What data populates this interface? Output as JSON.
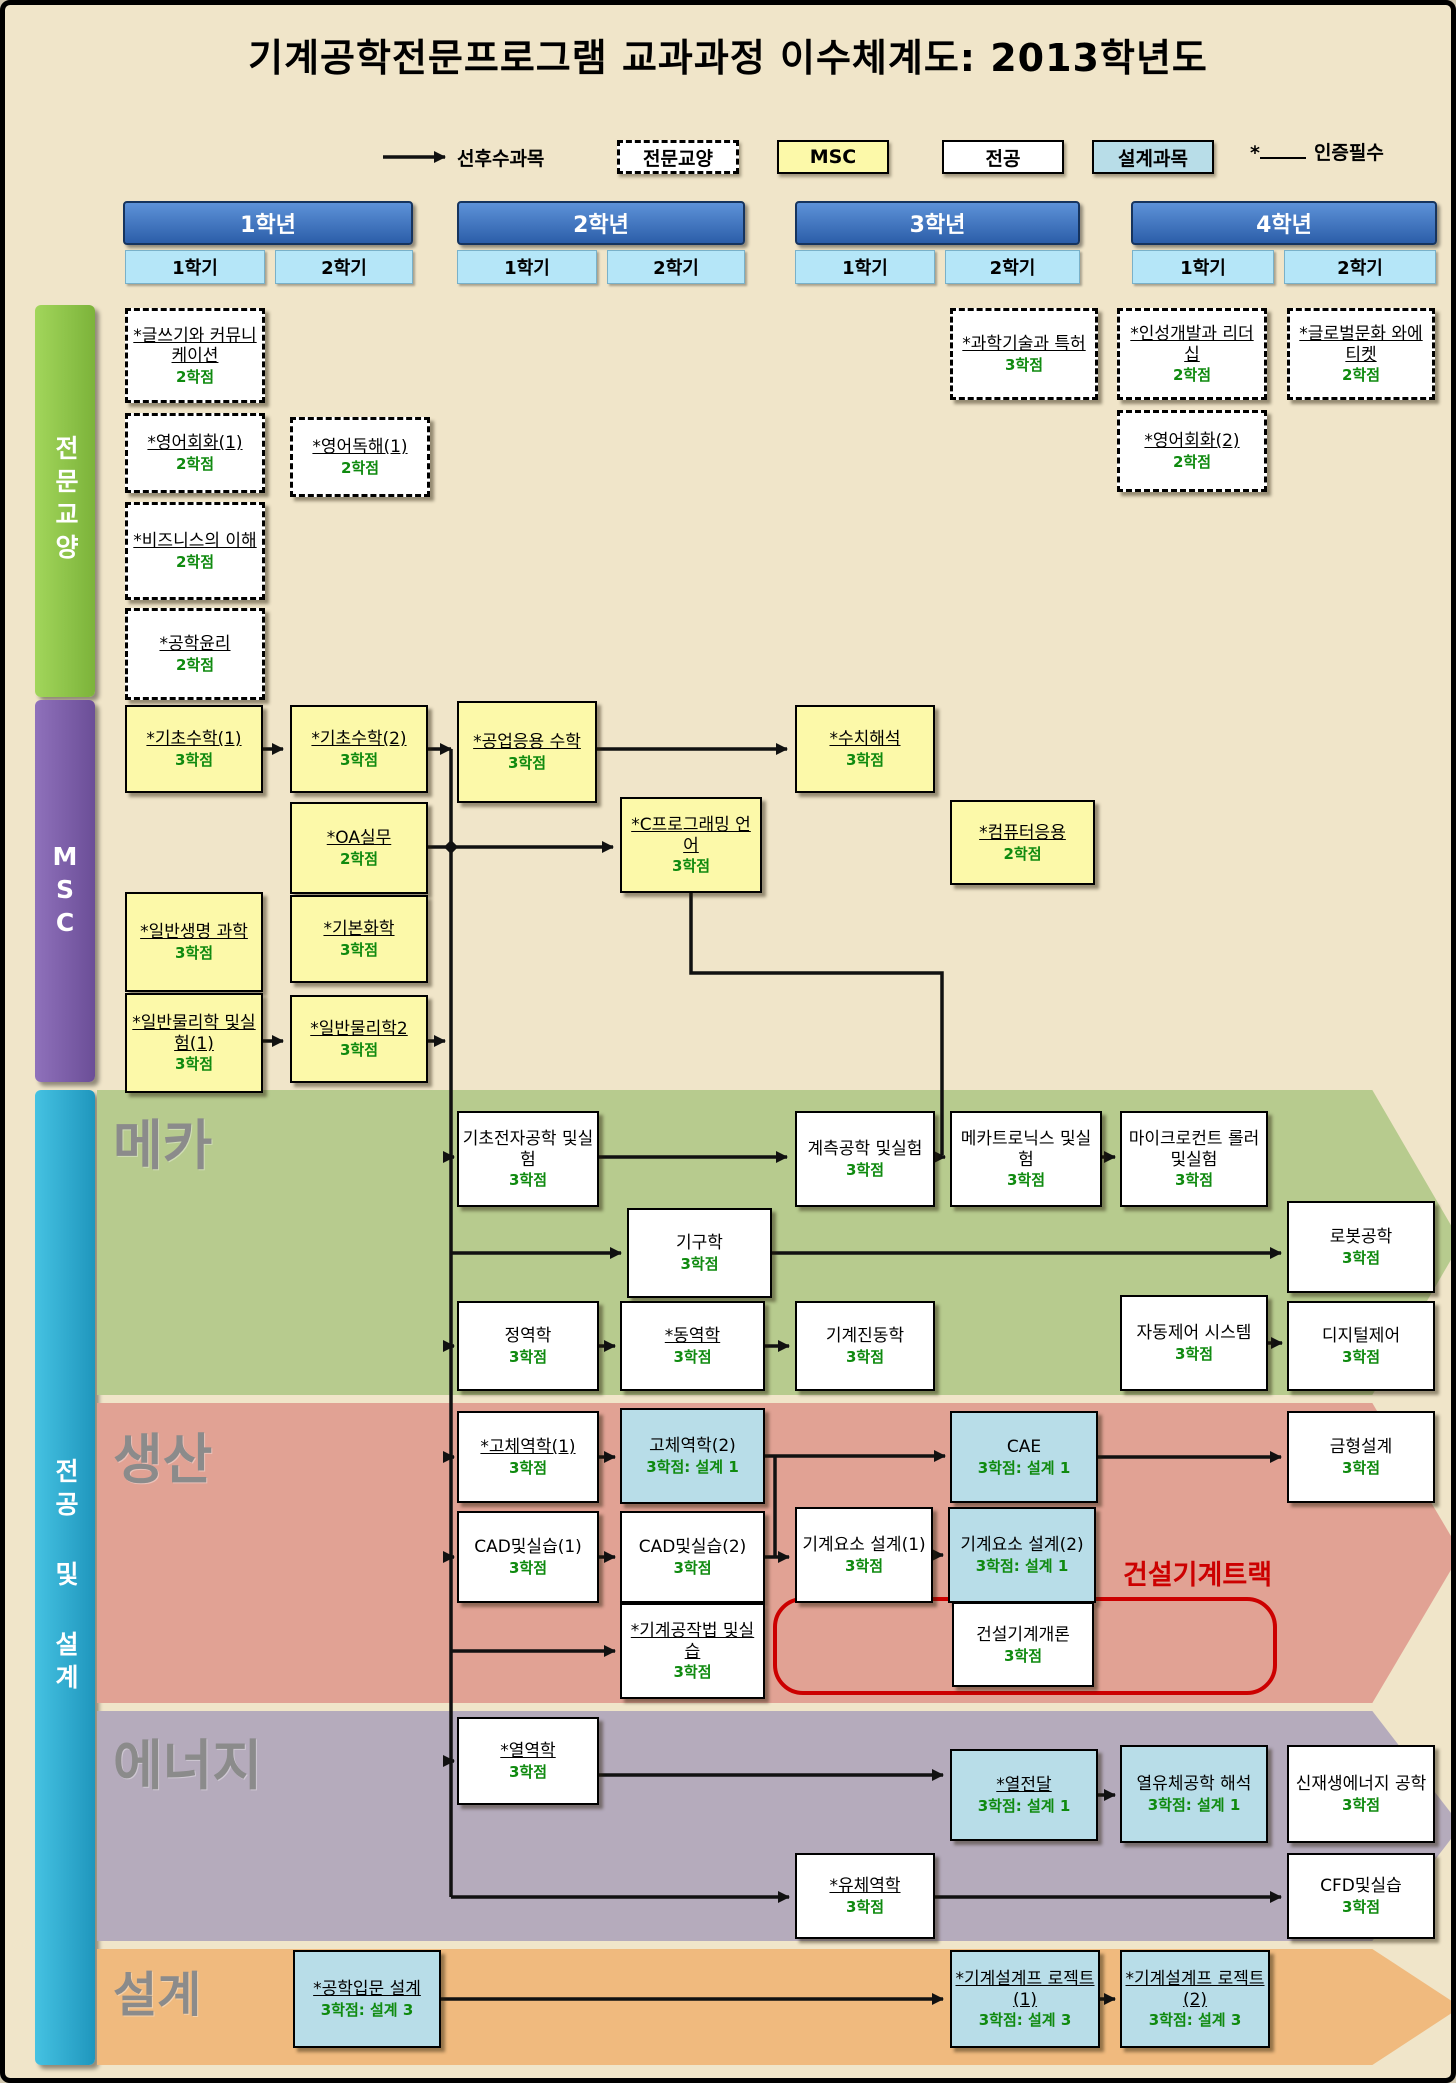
{
  "title": "기계공학전문프로그램 교과과정 이수체계도: 2013학년도",
  "legend": {
    "prereq_label": "선후수과목",
    "liberal_label": "전문교양",
    "msc_label": "MSC",
    "major_label": "전공",
    "design_label": "설계과목",
    "cert_label": "인증필수"
  },
  "years": [
    {
      "label": "1학년",
      "semesters": [
        "1학기",
        "2학기"
      ]
    },
    {
      "label": "2학년",
      "semesters": [
        "1학기",
        "2학기"
      ]
    },
    {
      "label": "3학년",
      "semesters": [
        "1학기",
        "2학기"
      ]
    },
    {
      "label": "4학년",
      "semesters": [
        "1학기",
        "2학기"
      ]
    }
  ],
  "sidebars": {
    "liberal": "전문교양",
    "msc": "MSC",
    "major": "전공 및 설계"
  },
  "bands": {
    "meka": "메카",
    "saengsan": "생산",
    "energy": "에너지",
    "seolgye": "설계"
  },
  "track": {
    "label": "건설기계트랙"
  },
  "colors": {
    "background": "#f0e5c9",
    "semester": "#b5e6f8",
    "liberal_sidebar": "#7cb33a",
    "msc_sidebar": "#6b4e97",
    "major_sidebar": "#1f96bd",
    "msc_box": "#fcf9a9",
    "design_box": "#b8dde8",
    "major_box": "#ffffff",
    "band_meka": "#b7cb8e",
    "band_saengsan": "#e1a294",
    "band_energy": "#b5abbc",
    "band_seolgye": "#f0ba7e",
    "credit_green": "#0f8a0f",
    "track_red": "#cc0000"
  },
  "courses": [
    {
      "name": "*글쓰기와 커뮤니케이션",
      "credits": "2학점"
    },
    {
      "name": "*영어회화(1)",
      "credits": "2학점"
    },
    {
      "name": "*영어독해(1)",
      "credits": "2학점"
    },
    {
      "name": "*비즈니스의 이해",
      "credits": "2학점"
    },
    {
      "name": "*공학윤리",
      "credits": "2학점"
    },
    {
      "name": "*과학기술과 특허",
      "credits": "3학점"
    },
    {
      "name": "*인성개발과 리더십",
      "credits": "2학점"
    },
    {
      "name": "*글로벌문화 와에티켓",
      "credits": "2학점"
    },
    {
      "name": "*영어회화(2)",
      "credits": "2학점"
    },
    {
      "name": "*기초수학(1)",
      "credits": "3학점"
    },
    {
      "name": "*기초수학(2)",
      "credits": "3학점"
    },
    {
      "name": "*공업응용 수학",
      "credits": "3학점"
    },
    {
      "name": "*OA실무",
      "credits": "2학점"
    },
    {
      "name": "*C프로그래밍 언어",
      "credits": "3학점"
    },
    {
      "name": "*수치해석",
      "credits": "3학점"
    },
    {
      "name": "*컴퓨터응용",
      "credits": "2학점"
    },
    {
      "name": "*일반생명 과학",
      "credits": "3학점"
    },
    {
      "name": "*기본화학",
      "credits": "3학점"
    },
    {
      "name": "*일반물리학 및실험(1)",
      "credits": "3학점"
    },
    {
      "name": "*일반물리학2",
      "credits": "3학점"
    },
    {
      "name": "기초전자공학 및실험",
      "credits": "3학점"
    },
    {
      "name": "계측공학 및실험",
      "credits": "3학점"
    },
    {
      "name": "메카트로닉스 및실험",
      "credits": "3학점"
    },
    {
      "name": "마이크로컨트 롤러및실험",
      "credits": "3학점"
    },
    {
      "name": "기구학",
      "credits": "3학점"
    },
    {
      "name": "로봇공학",
      "credits": "3학점"
    },
    {
      "name": "정역학",
      "credits": "3학점"
    },
    {
      "name": "*동역학",
      "credits": "3학점"
    },
    {
      "name": "기계진동학",
      "credits": "3학점"
    },
    {
      "name": "자동제어 시스템",
      "credits": "3학점"
    },
    {
      "name": "디지털제어",
      "credits": "3학점"
    },
    {
      "name": "*고체역학(1)",
      "credits": "3학점"
    },
    {
      "name": "고체역학(2)",
      "credits": "3학점: 설계 1"
    },
    {
      "name": "CAE",
      "credits": "3학점: 설계 1"
    },
    {
      "name": "금형설계",
      "credits": "3학점"
    },
    {
      "name": "CAD및실습(1)",
      "credits": "3학점"
    },
    {
      "name": "CAD및실습(2)",
      "credits": "3학점"
    },
    {
      "name": "기계요소 설계(1)",
      "credits": "3학점"
    },
    {
      "name": "기계요소 설계(2)",
      "credits": "3학점: 설계 1"
    },
    {
      "name": "*기계공작법 및실습",
      "credits": "3학점"
    },
    {
      "name": "건설기계개론",
      "credits": "3학점"
    },
    {
      "name": "*열역학",
      "credits": "3학점"
    },
    {
      "name": "*열전달",
      "credits": "3학점: 설계 1"
    },
    {
      "name": "열유체공학 해석",
      "credits": "3학점: 설계 1"
    },
    {
      "name": "신재생에너지 공학",
      "credits": "3학점"
    },
    {
      "name": "*유체역학",
      "credits": "3학점"
    },
    {
      "name": "CFD및실습",
      "credits": "3학점"
    },
    {
      "name": "*공학입문 설계",
      "credits": "3학점: 설계 3"
    },
    {
      "name": "*기계설계프 로젝트(1)",
      "credits": "3학점: 설계 3"
    },
    {
      "name": "*기계설계프 로젝트(2)",
      "credits": "3학점: 설계 3"
    }
  ]
}
